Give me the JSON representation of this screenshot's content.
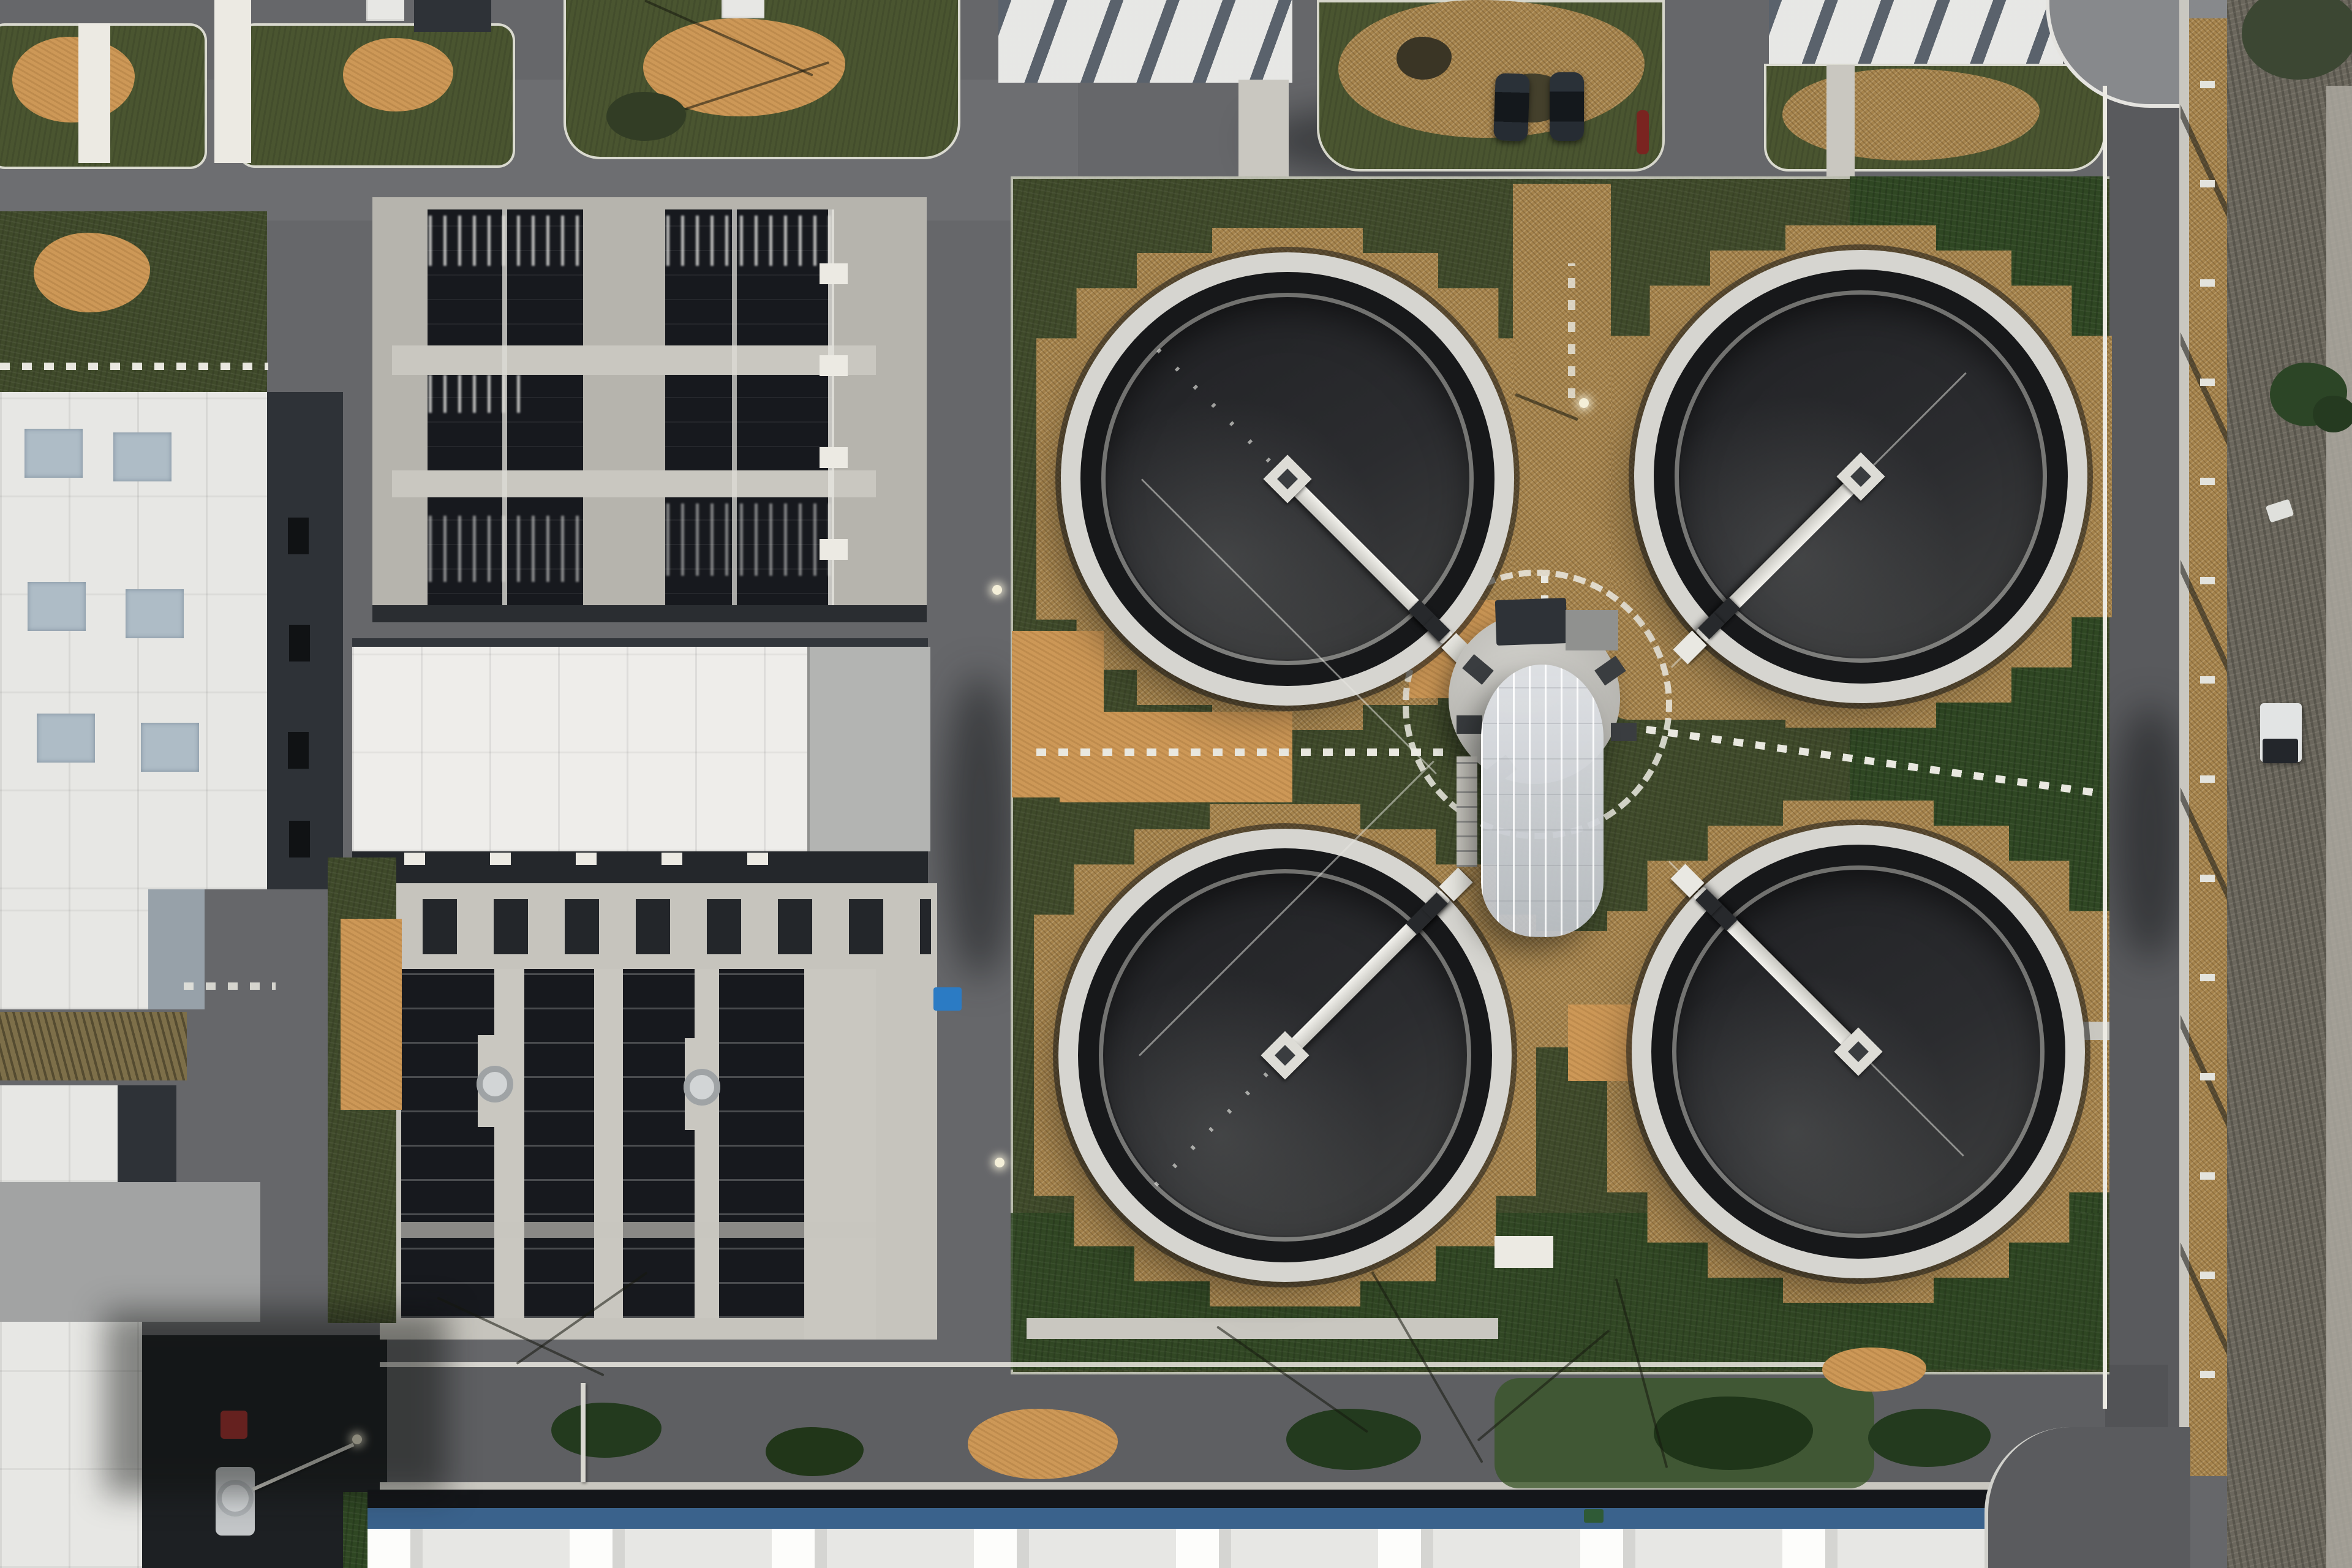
{
  "scene": {
    "description": "Top-down aerial drone photograph of a wastewater treatment plant with four circular secondary clarifier tanks around a central hub building with a greenhouse, two rectangular aeration basin blocks, flat-roofed industrial buildings, internal roads, a striped parking row with cars, lawns, mulch beds and a perimeter road with a scrub strip on the right.",
    "time_of_day": "late afternoon, low sun from upper right",
    "season": "early spring, bare trees"
  },
  "palette": {
    "asphalt": "#66676a",
    "asphalt_dark": "#5a5b5e",
    "concrete": "#c9c7c0",
    "concrete_bright": "#eceae3",
    "grass": "#3f4a2a",
    "grass_dark": "#2f4723",
    "grass_light": "#4a5530",
    "mulch": "#a5834c",
    "dirt": "#cd9857",
    "water_dark": "#17191e",
    "tank_water": "#2b2c2f",
    "tank_rim": "#d6d5d0",
    "roof_white": "#e7e7e4",
    "roof_gray": "#b3b4b2",
    "roof_blue": "#3a628c",
    "roof_slate": "#97a1a9",
    "wall_dark": "#2e3237",
    "car_dark": "#1d242b",
    "car_red": "#5c2429",
    "truck_red": "#b03230",
    "tank_silver": "#c3c6c8",
    "dumpster_blue": "#2b7bc4",
    "dumpster_green": "#2f5a36",
    "greenhouse": "#dcdfe3"
  },
  "inventory": {
    "clarifier_tanks": 4,
    "clarifier_bridges": 4,
    "aeration_basin_blocks": 2,
    "central_hub_with_greenhouse": 1,
    "flat_roof_buildings": 8,
    "parked_cars": 10,
    "tanker_truck": 1,
    "white_trailer": 1,
    "dumpsters": 2,
    "streetlights": 4,
    "dotted_walkways": 5,
    "parking_rows": 1
  }
}
